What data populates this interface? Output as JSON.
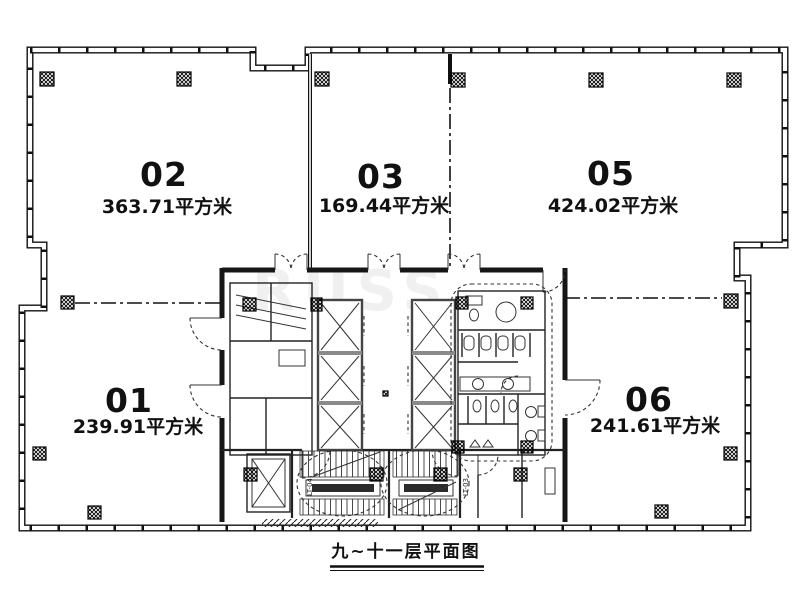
{
  "caption": "九~十一层平面图",
  "watermark": "RUSS",
  "units": [
    {
      "number": "02",
      "area": "363.71平方米"
    },
    {
      "number": "03",
      "area": "169.44平方米"
    },
    {
      "number": "05",
      "area": "424.02平方米"
    },
    {
      "number": "01",
      "area": "239.91平方米"
    },
    {
      "number": "06",
      "area": "241.61平方米"
    }
  ],
  "core": {
    "stair_labels": [
      "LT-04",
      "LT-03"
    ]
  }
}
